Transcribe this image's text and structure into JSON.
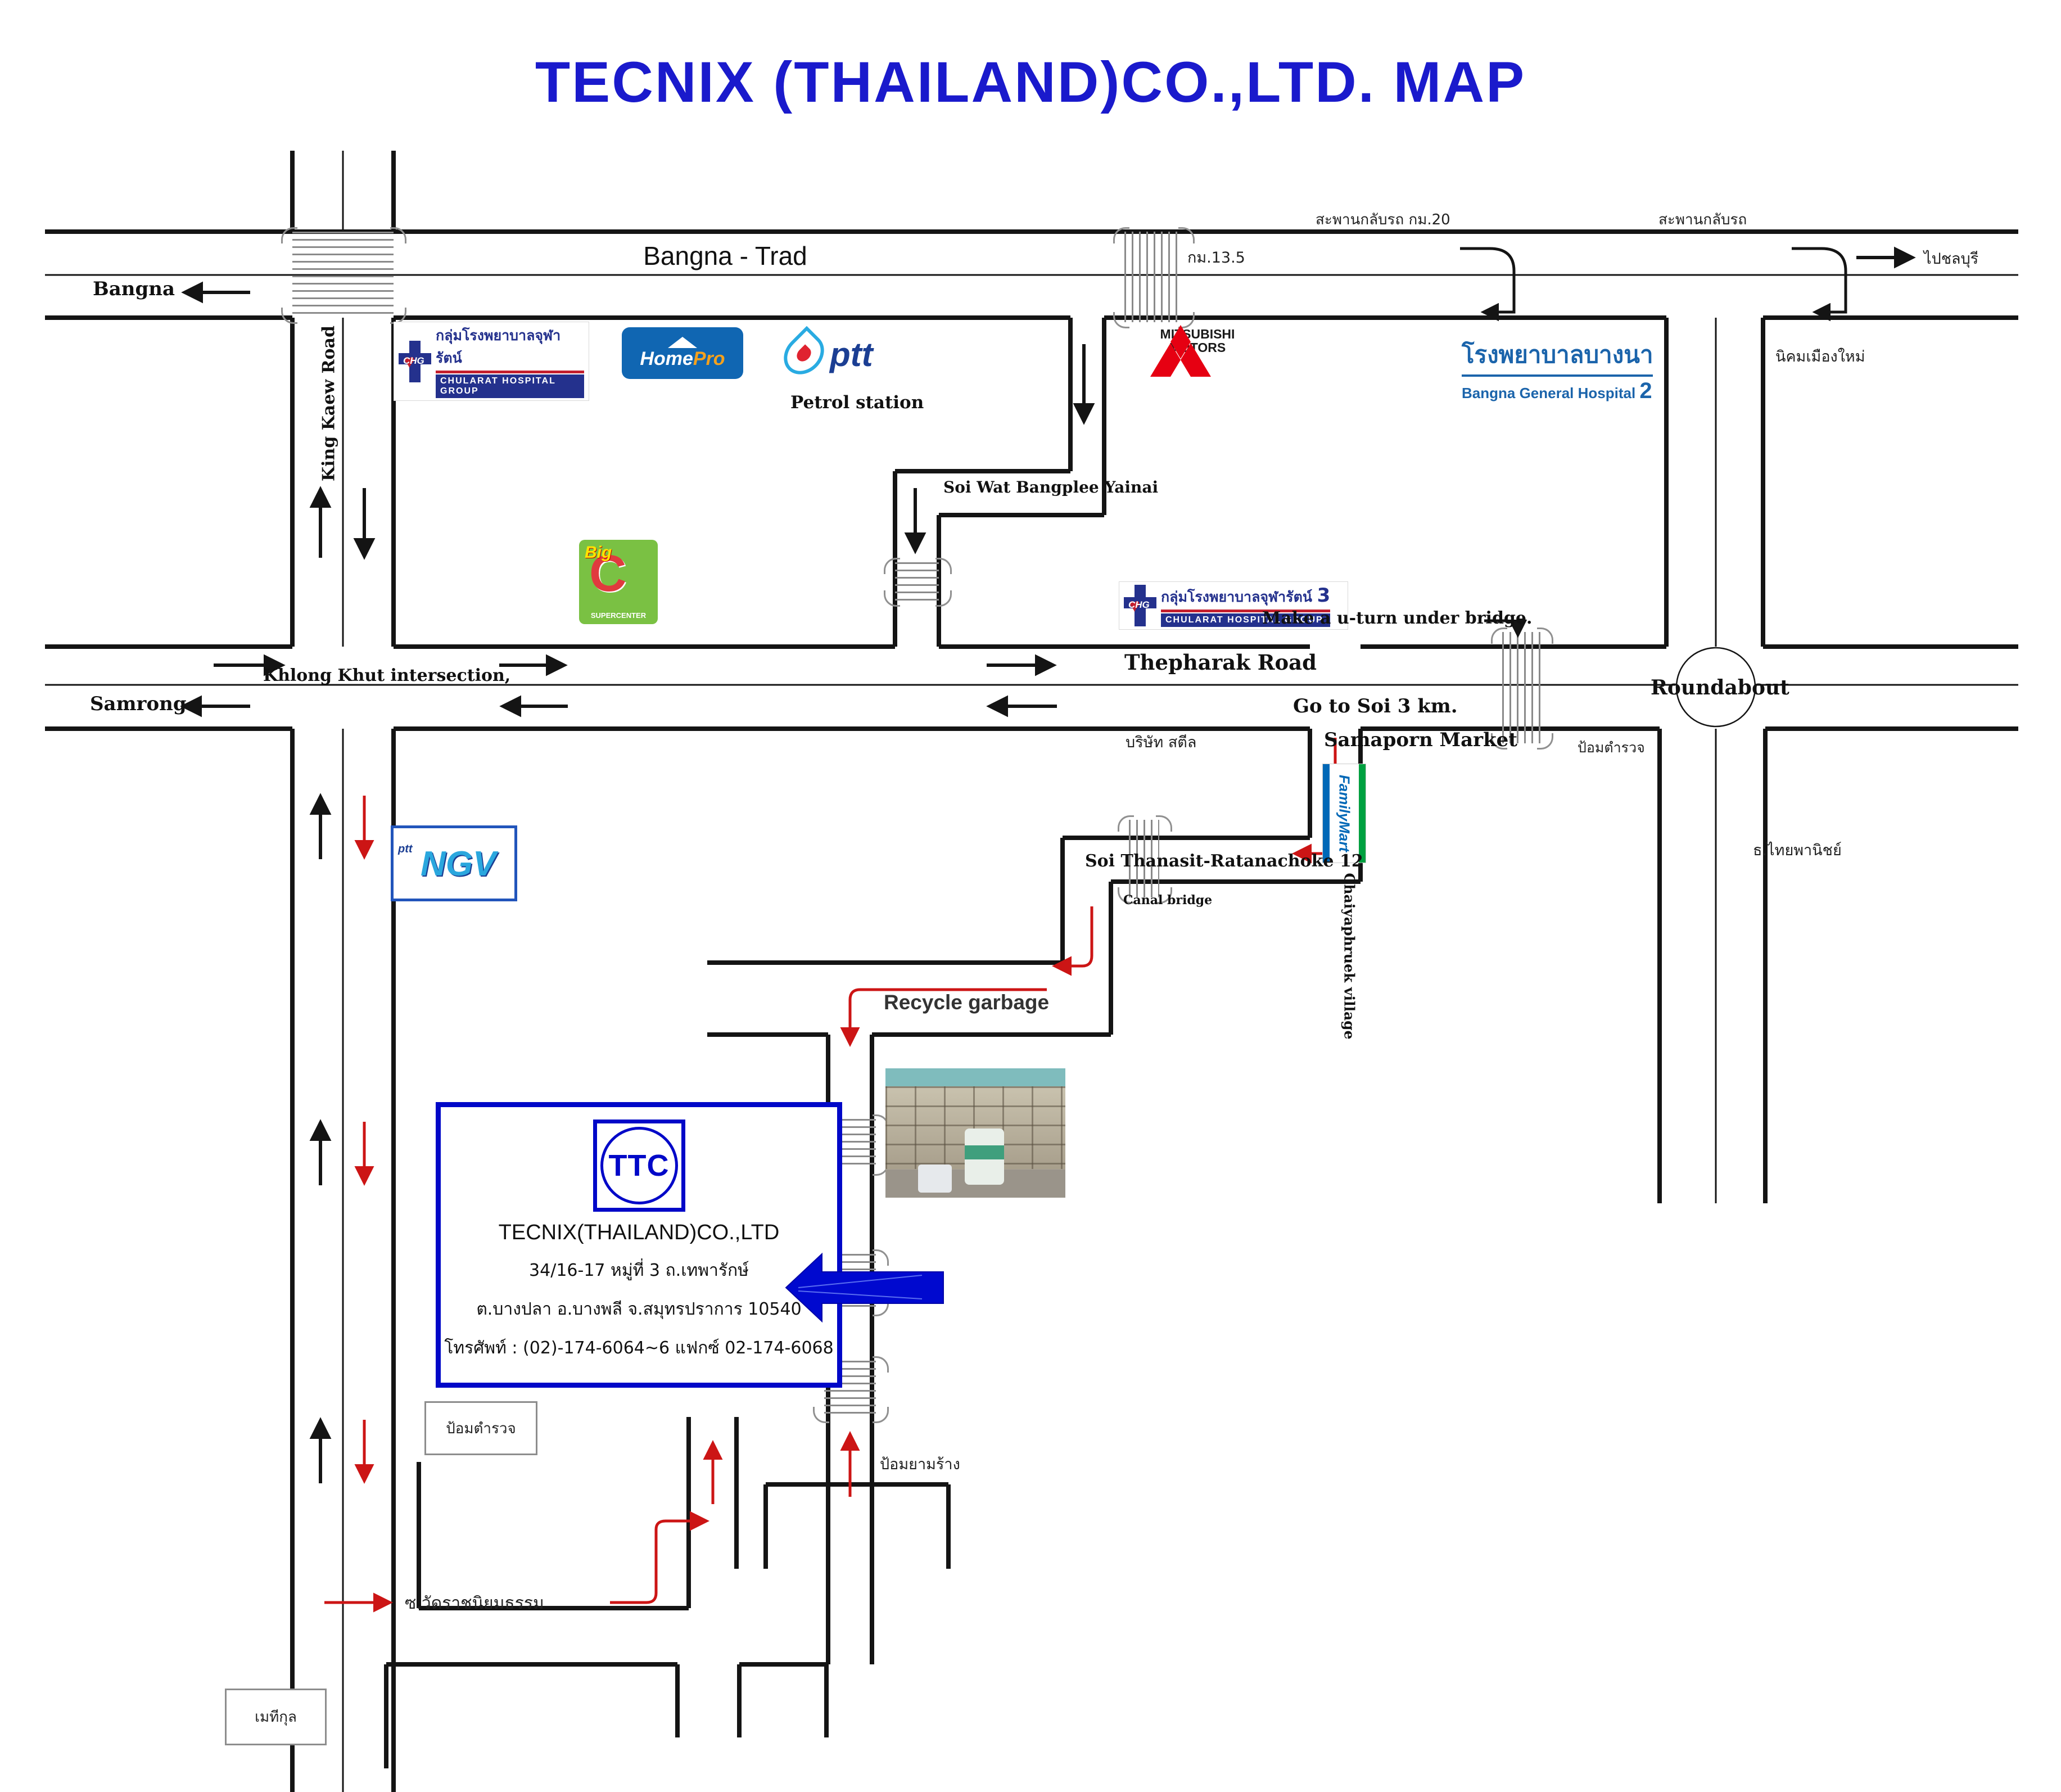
{
  "title": "TECNIX (THAILAND)CO.,LTD.  MAP",
  "labels": {
    "bangna_trad": "Bangna - Trad",
    "bangna": "Bangna",
    "samrong": "Samrong",
    "king_kaew_road": "King Kaew Road",
    "khlong_khut": "Khlong Khut intersection,",
    "thepharak_road": "Thepharak Road",
    "petrol_station": "Petrol station",
    "soi_wat_bangplee": "Soi Wat Bangplee Yainai",
    "u_turn_bridge_km20": "สะพานกลับรถ กม.20",
    "u_turn_bridge": "สะพานกลับรถ",
    "km_13_5": "กม.13.5",
    "to_chonburi": "ไปชลบุรี",
    "nikhom_mueang_mai": "นิคมเมืองใหม่",
    "make_u_turn": "Make a u-turn under bridge.",
    "go_to_soi": "Go to Soi 3 km.",
    "roundabout": "Roundabout",
    "steel_company": "บริษัท สตีล",
    "samaporn_market": "Samaporn Market",
    "police_box": "ป้อมตำรวจ",
    "thai_panich_bank": "ธ.ไทยพานิชย์",
    "chaiyaphruek_village": "Chaiyaphruek village",
    "soi_thanasit": "Soi Thanasit-Ratanachoke 12",
    "canal_bridge": "Canal bridge",
    "recycle_garbage": "Recycle garbage",
    "abandoned_guard_post": "ป้อมยามร้าง",
    "soi_wat_ratniyomtham": "ซ.วัดราชนิยมธรรม",
    "methikul": "เมทีกุล"
  },
  "company": {
    "logo_text": "TTC",
    "name": "TECNIX(THAILAND)CO.,LTD",
    "address_line1": "34/16-17 หมู่ที่ 3 ถ.เทพารักษ์",
    "address_line2": "ต.บางปลา อ.บางพลี จ.สมุทรปราการ 10540",
    "phone_line": "โทรศัพท์ : (02)-174-6064~6 แฟกซ์ 02-174-6068"
  },
  "logos": {
    "chularat": {
      "abbr": "CHG",
      "thai": "กลุ่มโรงพยาบาลจุฬารัตน์",
      "en": "CHULARAT HOSPITAL GROUP",
      "branch3": "3"
    },
    "homepro": {
      "home": "Home",
      "pro": "Pro"
    },
    "ptt": {
      "text": "ptt"
    },
    "bigc": {
      "big": "Big",
      "c": "C",
      "sub": "SUPERCENTER"
    },
    "mitsubishi": {
      "line1": "MITSUBISHI",
      "line2": "MOTORS"
    },
    "bangna_hospital": {
      "thai": "โรงพยาบาลบางนา",
      "en": "Bangna General Hospital",
      "num": "2"
    },
    "familymart": {
      "text": "FamilyMart"
    },
    "ngv": {
      "ptt": "ptt",
      "ngv": "NGV"
    }
  },
  "colors": {
    "title_blue": "#1a1acc",
    "route_red": "#cc1515",
    "road_black": "#141414",
    "ttc_blue": "#0008c8",
    "bridge_gray": "#8a8a8a"
  }
}
